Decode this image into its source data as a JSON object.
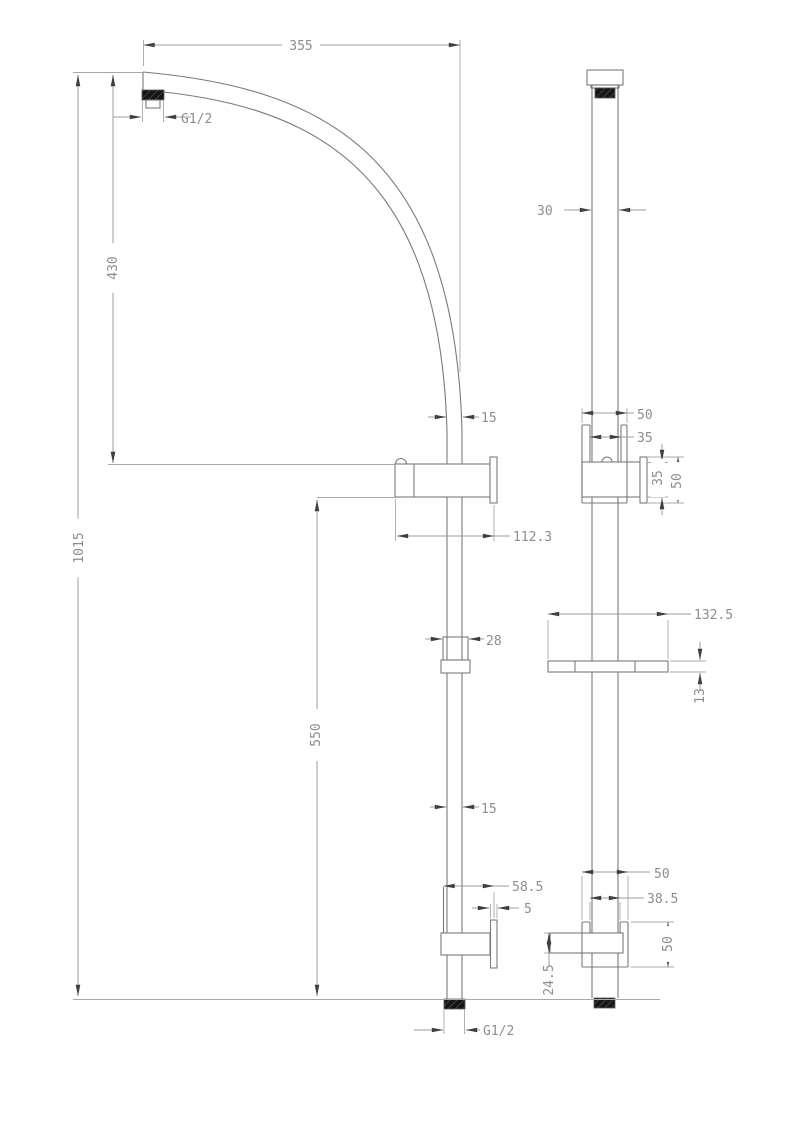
{
  "drawing": {
    "front": {
      "dim_arm_reach": "355",
      "thread_top": "G1/2",
      "dim_arm_drop": "430",
      "dim_total_height": "1015",
      "dim_rail_width_upper": "15",
      "dim_bracket_length": "112.3",
      "dim_lower_rail_length": "550",
      "dim_dish_mount_width": "28",
      "dim_rail_width_lower": "15",
      "dim_lower_bracket_length": "58.5",
      "dim_wall_plate_thickness": "5",
      "thread_bottom": "G1/2"
    },
    "side": {
      "dim_column_depth": "30",
      "dim_upper_bracket_width": "50",
      "dim_upper_slot_width": "35",
      "dim_upper_clamp_height": "35",
      "dim_upper_plate_height": "50",
      "dim_dish_length": "132.5",
      "dim_dish_thickness": "13",
      "dim_lower_bracket_width": "50",
      "dim_lower_slot_width": "38.5",
      "dim_lower_plate_height": "50",
      "dim_lower_block_height": "24.5"
    }
  }
}
